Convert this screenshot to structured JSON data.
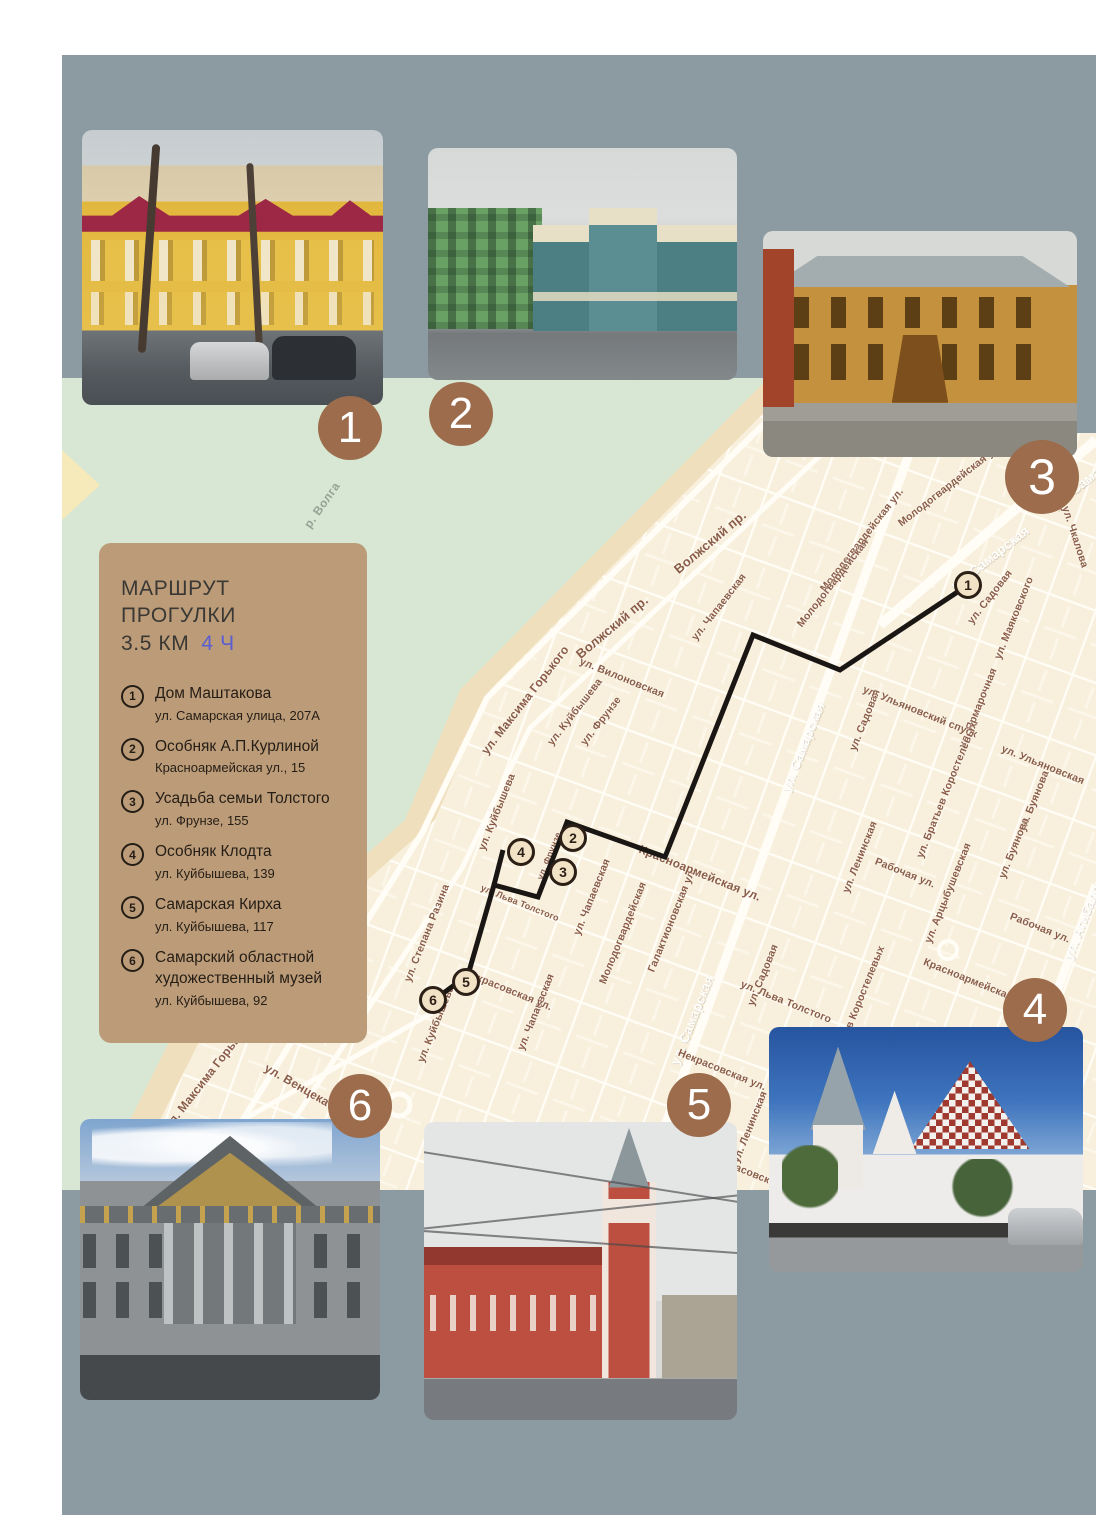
{
  "legend": {
    "title": "МАРШРУТ ПРОГУЛКИ",
    "distance": "3.5 КМ",
    "duration": "4 Ч",
    "panel_color": "#bc9c78",
    "duration_color": "#5a5ed2",
    "items": [
      {
        "num": "1",
        "title": "Дом Маштакова",
        "address": "ул. Самарская улица, 207А"
      },
      {
        "num": "2",
        "title": "Особняк А.П.Курлиной",
        "address": "Красноармейская ул., 15"
      },
      {
        "num": "3",
        "title": "Усадьба семьи Толстого",
        "address": "ул. Фрунзе, 155"
      },
      {
        "num": "4",
        "title": "Особняк Клодта",
        "address": "ул. Куйбышева, 139"
      },
      {
        "num": "5",
        "title": "Самарская Кирха",
        "address": "ул. Куйбышева, 117"
      },
      {
        "num": "6",
        "title": "Самарский областной художественный музей",
        "address": "ул. Куйбышева, 92"
      }
    ]
  },
  "badges": [
    {
      "num": "1"
    },
    {
      "num": "2"
    },
    {
      "num": "3"
    },
    {
      "num": "4"
    },
    {
      "num": "5"
    },
    {
      "num": "6"
    }
  ],
  "map": {
    "colors": {
      "background": "#f8f0dd",
      "water_green": "#d7e7d3",
      "shore_sand": "#f0dfbc",
      "streets": "#fffdf6",
      "label_brown": "#8a5c48",
      "route_black": "#1a1613",
      "frame_gray": "#8c9aa2"
    },
    "route": {
      "main": "M906,207 L778,292 L691,257 L603,479 L505,444 L476,519 L432,507 L406,597 L372,622",
      "spur": "M432,507 L441,472"
    },
    "markers": [
      {
        "n": "1",
        "x": 906,
        "y": 207
      },
      {
        "n": "2",
        "x": 511,
        "y": 460
      },
      {
        "n": "3",
        "x": 501,
        "y": 494
      },
      {
        "n": "4",
        "x": 459,
        "y": 474
      },
      {
        "n": "5",
        "x": 404,
        "y": 604
      },
      {
        "n": "6",
        "x": 371,
        "y": 622
      }
    ],
    "street_labels": [
      {
        "t": "р. Волга",
        "x": 260,
        "y": 127,
        "r": -55,
        "s": 12,
        "c": "water"
      },
      {
        "t": "Волжский пр.",
        "x": 648,
        "y": 164,
        "r": -40,
        "s": 13
      },
      {
        "t": "Волжский пр.",
        "x": 550,
        "y": 249,
        "r": -40,
        "s": 13
      },
      {
        "t": "ул. Максима Горького",
        "x": 463,
        "y": 322,
        "r": -52,
        "s": 12
      },
      {
        "t": "ул. Максима Горького",
        "x": 146,
        "y": 697,
        "r": -52,
        "s": 12
      },
      {
        "t": "ул. Куйбышева",
        "x": 513,
        "y": 334,
        "r": -52
      },
      {
        "t": "ул. Куйбышева",
        "x": 435,
        "y": 434,
        "r": -68
      },
      {
        "t": "ул. Куйбышева",
        "x": 374,
        "y": 646,
        "r": -68
      },
      {
        "t": "ул. Фрунзе",
        "x": 539,
        "y": 343,
        "r": -52
      },
      {
        "t": "ул. Фрунзе",
        "x": 487,
        "y": 478,
        "r": -68,
        "s": 9
      },
      {
        "t": "ул. Чапаевская",
        "x": 657,
        "y": 229,
        "r": -52
      },
      {
        "t": "ул. Чапаевская",
        "x": 530,
        "y": 519,
        "r": -68
      },
      {
        "t": "ул. Чапаевская",
        "x": 474,
        "y": 634,
        "r": -68
      },
      {
        "t": "Молодогвардейская ул.",
        "x": 800,
        "y": 162,
        "r": -52
      },
      {
        "t": "Молодогвардейская",
        "x": 771,
        "y": 205,
        "r": -52
      },
      {
        "t": "Молодогвардейская ул.",
        "x": 888,
        "y": 107,
        "r": -38
      },
      {
        "t": "Молодогвардейская",
        "x": 561,
        "y": 555,
        "r": -68
      },
      {
        "t": "Галактионовская ул.",
        "x": 610,
        "y": 542,
        "r": -68
      },
      {
        "t": "ул. Самарская",
        "x": 741,
        "y": 369,
        "r": -68,
        "s": 13,
        "c": "w"
      },
      {
        "t": "ул. Самарская",
        "x": 630,
        "y": 642,
        "r": -68,
        "s": 13,
        "c": "w"
      },
      {
        "t": "ул. Самарская",
        "x": 928,
        "y": 180,
        "r": -38,
        "s": 13,
        "c": "w"
      },
      {
        "t": "ул. Сама",
        "x": 1014,
        "y": 110,
        "r": -38,
        "s": 13,
        "c": "w"
      },
      {
        "t": "ул. Садовая",
        "x": 928,
        "y": 219,
        "r": -52
      },
      {
        "t": "ул. Садовая",
        "x": 803,
        "y": 342,
        "r": -68
      },
      {
        "t": "ул. Садовая",
        "x": 701,
        "y": 597,
        "r": -68
      },
      {
        "t": "ул. Маяковского",
        "x": 952,
        "y": 240,
        "r": -68
      },
      {
        "t": "ул. Чкалова",
        "x": 1013,
        "y": 159,
        "r": 72
      },
      {
        "t": "ул. Ярмарочная",
        "x": 916,
        "y": 330,
        "r": -68
      },
      {
        "t": "ул. Ульяновский спуск",
        "x": 858,
        "y": 334,
        "r": 22
      },
      {
        "t": "ул. Ульяновская",
        "x": 981,
        "y": 387,
        "r": 22
      },
      {
        "t": "ул. Вилоновская",
        "x": 560,
        "y": 300,
        "r": 22
      },
      {
        "t": "Красноармейская ул.",
        "x": 638,
        "y": 495,
        "r": 22,
        "s": 12
      },
      {
        "t": "Красноармейская ул.",
        "x": 915,
        "y": 605,
        "r": 22
      },
      {
        "t": "ул. Льва Толстого",
        "x": 724,
        "y": 624,
        "r": 22
      },
      {
        "t": "ул. Льва Толстого",
        "x": 458,
        "y": 525,
        "r": 22,
        "s": 9
      },
      {
        "t": "Некрасовская ул.",
        "x": 446,
        "y": 612,
        "r": 22
      },
      {
        "t": "Некрасовская ул.",
        "x": 660,
        "y": 692,
        "r": 22
      },
      {
        "t": "Некрасовская ул.",
        "x": 693,
        "y": 797,
        "r": 22
      },
      {
        "t": "ул. Ленинская",
        "x": 798,
        "y": 479,
        "r": -68
      },
      {
        "t": "ул. Ленинская",
        "x": 688,
        "y": 749,
        "r": -68
      },
      {
        "t": "ул. Степана Разина",
        "x": 365,
        "y": 555,
        "r": -68
      },
      {
        "t": "Рабочая ул.",
        "x": 843,
        "y": 495,
        "r": 22
      },
      {
        "t": "Рабочая ул.",
        "x": 978,
        "y": 550,
        "r": 22
      },
      {
        "t": "ул. Братьев Коростелевых",
        "x": 885,
        "y": 412,
        "r": -68
      },
      {
        "t": "Братьев Коростелевых",
        "x": 796,
        "y": 627,
        "r": -68
      },
      {
        "t": "ул. Буянова",
        "x": 972,
        "y": 423,
        "r": -68
      },
      {
        "t": "ул. Буянова",
        "x": 952,
        "y": 470,
        "r": -68
      },
      {
        "t": "ул. Арцыбушевская",
        "x": 886,
        "y": 515,
        "r": -68
      },
      {
        "t": "ул. Агибалова",
        "x": 1023,
        "y": 537,
        "r": -68,
        "s": 13,
        "c": "w"
      },
      {
        "t": "ул. Венцека",
        "x": 235,
        "y": 707,
        "r": 30,
        "s": 12
      }
    ]
  }
}
